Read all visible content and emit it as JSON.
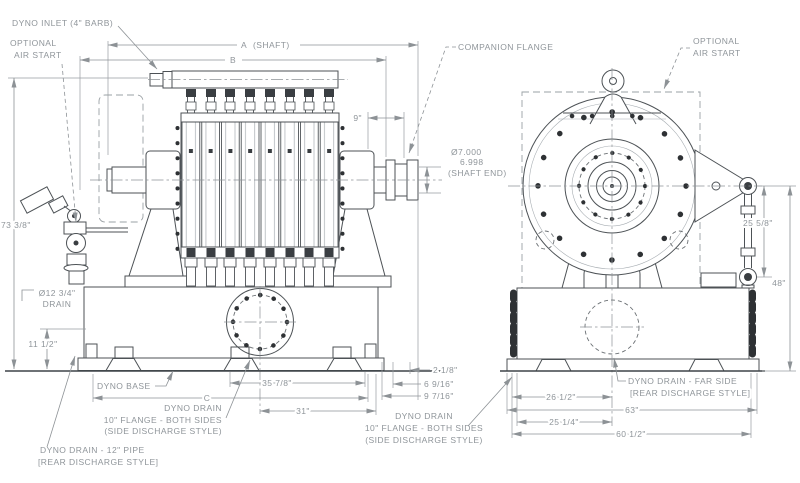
{
  "drawing": {
    "type": "dynamometer dimensional drawing",
    "views": [
      "side view",
      "end view"
    ],
    "colors": {
      "background": "#ffffff",
      "machine_line": "#4d5256",
      "dimension_line": "#8d9296",
      "label_text": "#8f959a",
      "bolt_fill": "#2e3134"
    }
  },
  "labels": {
    "dyno_inlet": "DYNO INLET (4\" BARB)",
    "optional_air_start_1": "OPTIONAL",
    "optional_air_start_2": "AIR START",
    "dim_a": "A",
    "dim_a_note": "(SHAFT)",
    "dim_b": "B",
    "companion_flange": "COMPANION FLANGE",
    "dim_9in": "9\"",
    "shaft_dia_upper": "Ø7.000",
    "shaft_dia_lower": "6.998",
    "shaft_end_note": "(SHAFT END)",
    "dim_73_3_8": "73 3/8\"",
    "drain_dia": "Ø12 3/4\"",
    "drain_dia_note": "DRAIN",
    "dim_11_1_2": "11 1/2\"",
    "dyno_base": "DYNO BASE",
    "dim_c": "C",
    "dim_35_7_8": "35 7/8\"",
    "dim_31": "31\"",
    "dim_2_1_8": "2 1/8\"",
    "dim_6_9_16": "6 9/16\"",
    "dim_9_7_16": "9 7/16\"",
    "dyno_drain_side_1": "DYNO DRAIN",
    "dyno_drain_side_2": "10\" FLANGE - BOTH SIDES",
    "dyno_drain_side_3": "(SIDE DISCHARGE STYLE)",
    "dyno_drain_rear_1": "DYNO DRAIN - 12\" PIPE",
    "dyno_drain_rear_2": "[REAR DISCHARGE STYLE]",
    "dyno_drain_far_1": "DYNO DRAIN - FAR SIDE",
    "dyno_drain_far_2": "[REAR DISCHARGE STYLE]",
    "dim_25_5_8": "25 5/8\"",
    "dim_48": "48\"",
    "dim_26_1_2": "26 1/2\"",
    "dim_63": "63\"",
    "dim_25_1_4": "25 1/4\"",
    "dim_60_1_2": "60 1/2\""
  }
}
